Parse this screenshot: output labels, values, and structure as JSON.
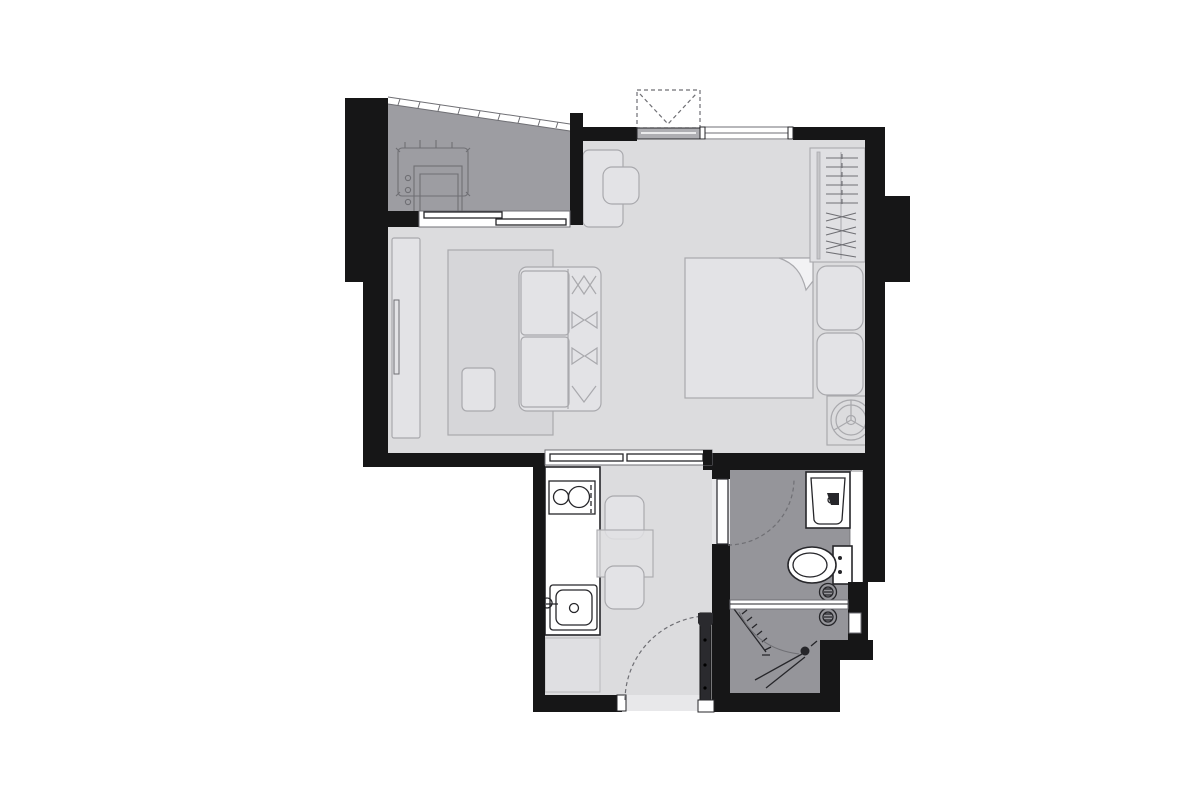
{
  "document": {
    "kind": "floor-plan",
    "visible_text": []
  },
  "colors": {
    "wall": "#161617",
    "floor_main": "#dcdcde",
    "floor_balcony": "#9d9da2",
    "floor_bath": "#95959a",
    "furn_fill": "#e3e3e6",
    "furn_stroke": "#a9a9ad",
    "white": "#ffffff",
    "line_dark": "#26262a",
    "line_mid": "#6f6f74",
    "rug_fill": "#d6d6d9",
    "sill_fill": "#aeaeb2",
    "threshold": "#e8e8ea"
  },
  "rooms": [
    {
      "name": "balcony",
      "floor": "dark-gray",
      "features": [
        "washing-machine",
        "ac-outdoor-unit",
        "diagonal-railing",
        "sliding-door"
      ]
    },
    {
      "name": "living-sleeping-area",
      "floor": "light-gray",
      "features": [
        "tv-console",
        "rug",
        "sofa",
        "ottoman",
        "desk",
        "desk-chair",
        "bed",
        "pillows",
        "wardrobe-hangers",
        "fan-coil-unit",
        "window",
        "ac-ledge"
      ]
    },
    {
      "name": "kitchen-dining-corridor",
      "floor": "light-gray",
      "features": [
        "kitchen-counter",
        "cooktop-2-burner",
        "kitchen-sink",
        "dining-table",
        "dining-chairs",
        "floor-mat",
        "entrance-door"
      ]
    },
    {
      "name": "bathroom",
      "floor": "mid-gray",
      "features": [
        "swing-door",
        "washbasin-vanity",
        "toilet",
        "floor-drains",
        "wall-niche"
      ]
    },
    {
      "name": "shower",
      "floor": "mid-gray",
      "features": [
        "glass-partition",
        "shower-door",
        "shower-head-spray"
      ]
    }
  ],
  "icons": [
    "washing-machine-icon",
    "ac-outdoor-unit-icon",
    "cooktop-icon",
    "sink-icon",
    "toilet-icon",
    "washbasin-icon",
    "floor-drain-icon",
    "fan-coil-icon",
    "clothes-hanger-icon",
    "door-swing-icon",
    "window-icon",
    "shower-spray-icon"
  ]
}
